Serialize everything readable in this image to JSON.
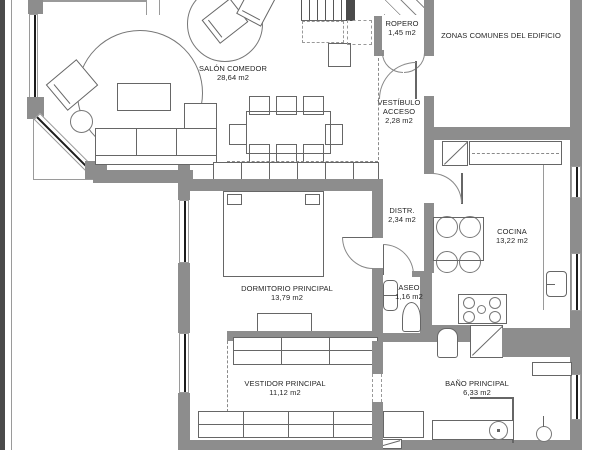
{
  "plan": {
    "type": "apartment-floor-plan",
    "units": "m2",
    "colors": {
      "wall": "#8d8d8d",
      "line": "#666666",
      "text": "#262626",
      "background": "#ffffff",
      "window_glass": "#1c1c1c"
    }
  },
  "rooms": {
    "salon": {
      "name": "SALÓN COMEDOR",
      "area": "28,64 m2"
    },
    "ropero": {
      "name": "ROPERO",
      "area": "1,45 m2"
    },
    "zonas": {
      "name": "ZONAS COMUNES DEL EDIFICIO"
    },
    "vestibulo": {
      "name": "VESTÍBULO",
      "name2": "ACCESO",
      "area": "2,28 m2"
    },
    "distribuidor": {
      "name": "DISTR.",
      "area": "2,34 m2"
    },
    "cocina": {
      "name": "COCINA",
      "area": "13,22 m2"
    },
    "dormitorio": {
      "name": "DORMITORIO PRINCIPAL",
      "area": "13,79 m2"
    },
    "aseo": {
      "name": "ASEO",
      "area": "1,16 m2"
    },
    "vestidor": {
      "name": "VESTIDOR PRINCIPAL",
      "area": "11,12 m2"
    },
    "bano": {
      "name": "BAÑO PRINCIPAL",
      "area": "6,33 m2"
    }
  }
}
